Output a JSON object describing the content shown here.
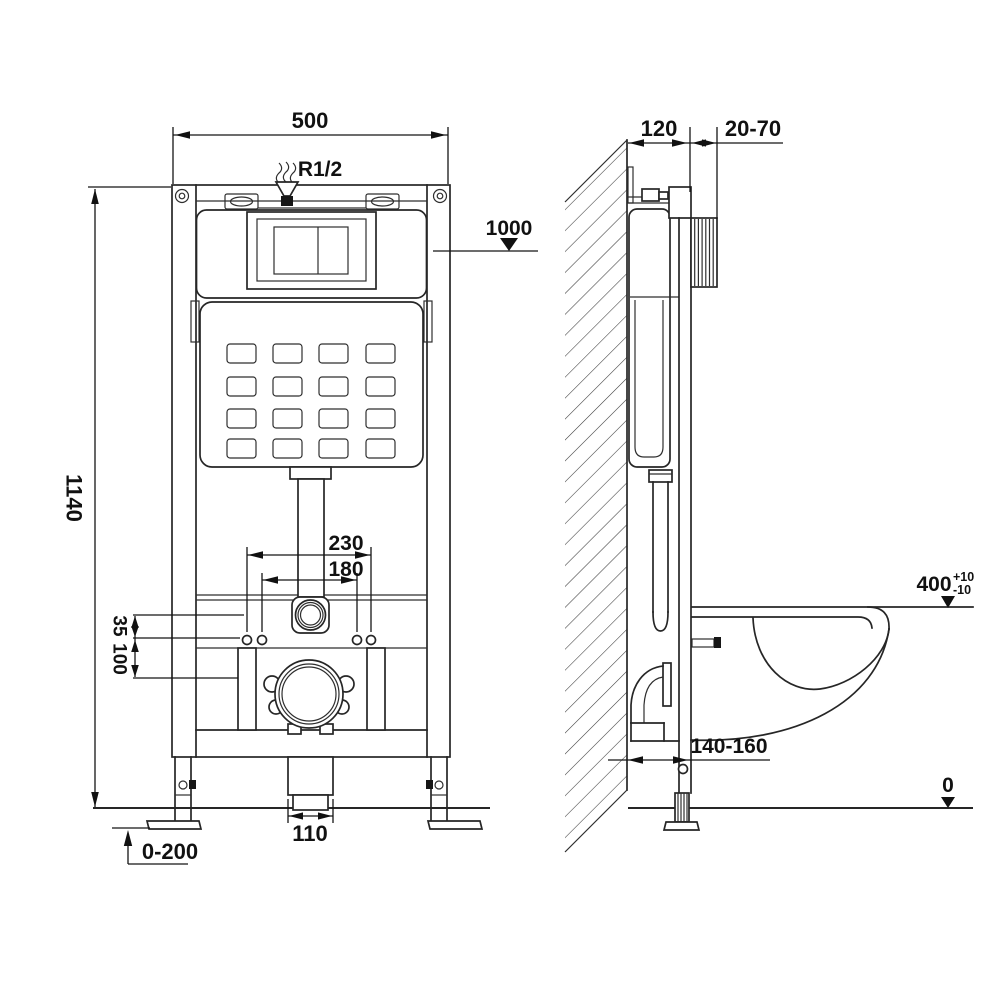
{
  "drawing_title": "concealed-cistern-wc-frame-installation-dimensions",
  "front_view": {
    "frame_width": "500",
    "water_inlet": "R1/2",
    "frame_height": "1140",
    "inlet_level": "1000",
    "fixing_width_outer": "230",
    "fixing_width_inner": "180",
    "offset_small": "35",
    "offset_large": "100",
    "drain_pipe_width": "110",
    "foot_adjust": "0-200"
  },
  "side_view": {
    "frame_depth": "120",
    "wall_finish": "20-70",
    "bowl_height": "400",
    "bowl_height_tol_plus": "+10",
    "bowl_height_tol_minus": "-10",
    "outlet_distance": "140-160",
    "floor_level": "0"
  }
}
